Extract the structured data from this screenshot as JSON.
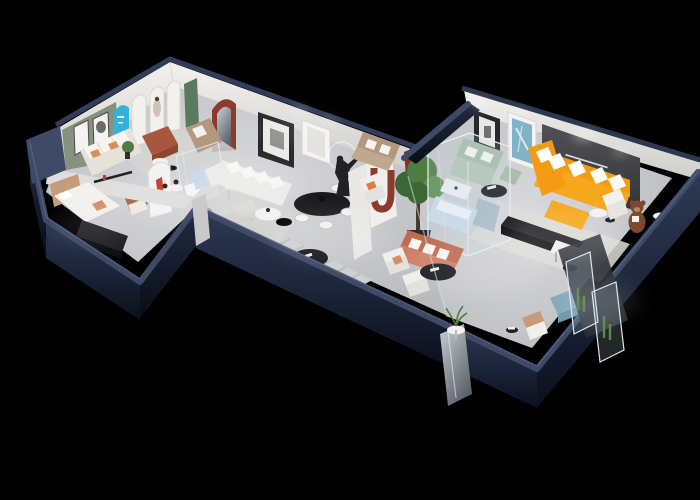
{
  "scene": {
    "background": "#000000",
    "kind": "isometric-showroom-cutaway-render",
    "wall_text_legible": false
  },
  "palette": {
    "navy_top": "#3e4a66",
    "navy_top_bright": "#55618a",
    "navy_face_top": "#2c3850",
    "navy_face_bottom": "#0c1120",
    "floor": "#c7c9cd",
    "floor_light": "#e2e3e5",
    "connector_floor": "#c4c6ca",
    "wall_white": "#edebe8",
    "wall_shade": "#d6d4d1",
    "sage_wall": "#87927e",
    "cyan_accent": "#35b0d8",
    "green_door": "#5a7a5f",
    "brick_red": "#8d3a32",
    "junction_red": "#7e3329",
    "orange_sofa": "#f39c13",
    "orange_sofa_light": "#f7a71e",
    "sage_sofa": "#aabcaa",
    "sage_sofa_light": "#b6c6b4",
    "terracotta_sofa": "#bf6a50",
    "terracotta_light": "#cf7d63",
    "tan_sofa": "#b3977f",
    "tan_sofa_light": "#c2a78f",
    "beige_sofa": "#e7e2d8",
    "leather_brown": "#9a6242",
    "bed_tan": "#c59a7d",
    "black_furniture": "#17181b",
    "slogan_wall": "#46474c",
    "teal_art": "#7fb3c6",
    "plant_green": "#4e7d42",
    "plant_dark": "#3c6633",
    "teddy_brown": "#7b4a2f",
    "teddy_muzzle": "#b08a60",
    "powder_blue": "#6f98ab",
    "powder_blue_light": "#84aabb",
    "pale_blue": "#ccdaea",
    "steel_blue": "#9fb4c4",
    "rug_light": "#d6d5d2",
    "white": "#f7f6f4",
    "cream": "#ecece6"
  },
  "wings": [
    {
      "id": "left-wing",
      "rooms": [
        {
          "id": "display-room-a",
          "furniture": [
            "sage-accent-wall",
            "framed-art-pair",
            "cyan-arch-panel",
            "white-arch-posters",
            "green-door",
            "beige-sofa",
            "tan-loveseat",
            "red-ottoman",
            "round-tables",
            "potted-plant",
            "area-rug"
          ]
        },
        {
          "id": "foyer-corridor",
          "furniture": [
            "red-arch-mirror-niche",
            "logo-arch-panel",
            "leather-armchair",
            "glass-display-partition",
            "pale-blue-display-sofa",
            "floor-lamp",
            "blue-armchair",
            "desk-and-chair",
            "runner-rug",
            "black-oval-table"
          ]
        },
        {
          "id": "bedroom-display",
          "furniture": [
            "bed",
            "headboard",
            "black-media-cabinet",
            "wall-shelf",
            "armchair"
          ]
        }
      ]
    },
    {
      "id": "center-wing",
      "rooms": [
        {
          "id": "living-room-display",
          "furniture": [
            "white-corner-sofa",
            "nesting-coffee-tables",
            "black-oval-dining-table",
            "dining-chairs",
            "mannequin-statue",
            "ring-wall-art",
            "black-frame-art",
            "white-frame-art",
            "white-pillar",
            "red-u-arch-decor",
            "accent-armchair",
            "indoor-tree"
          ]
        }
      ]
    },
    {
      "id": "right-wing",
      "rooms": [
        {
          "id": "main-showroom",
          "furniture": [
            "orange-sectional-sofa",
            "throw-pillows",
            "black-media-console",
            "slogan-accent-wall",
            "teal-abstract-painting",
            "black-frame-art",
            "sage-sectional-sofa",
            "round-black-table",
            "glass-room",
            "pale-blue-bed",
            "white-island",
            "white-armchair",
            "teddy-bear-figure",
            "writing-desk-set",
            "terracotta-sofa",
            "white-lounge-chairs",
            "black-oval-table",
            "plant-side-table",
            "blue-ottoman",
            "beige-armchair",
            "side-table",
            "glass-display-cases",
            "cactus-plants",
            "mirror-door-panel",
            "showroom-rug"
          ]
        }
      ]
    }
  ]
}
